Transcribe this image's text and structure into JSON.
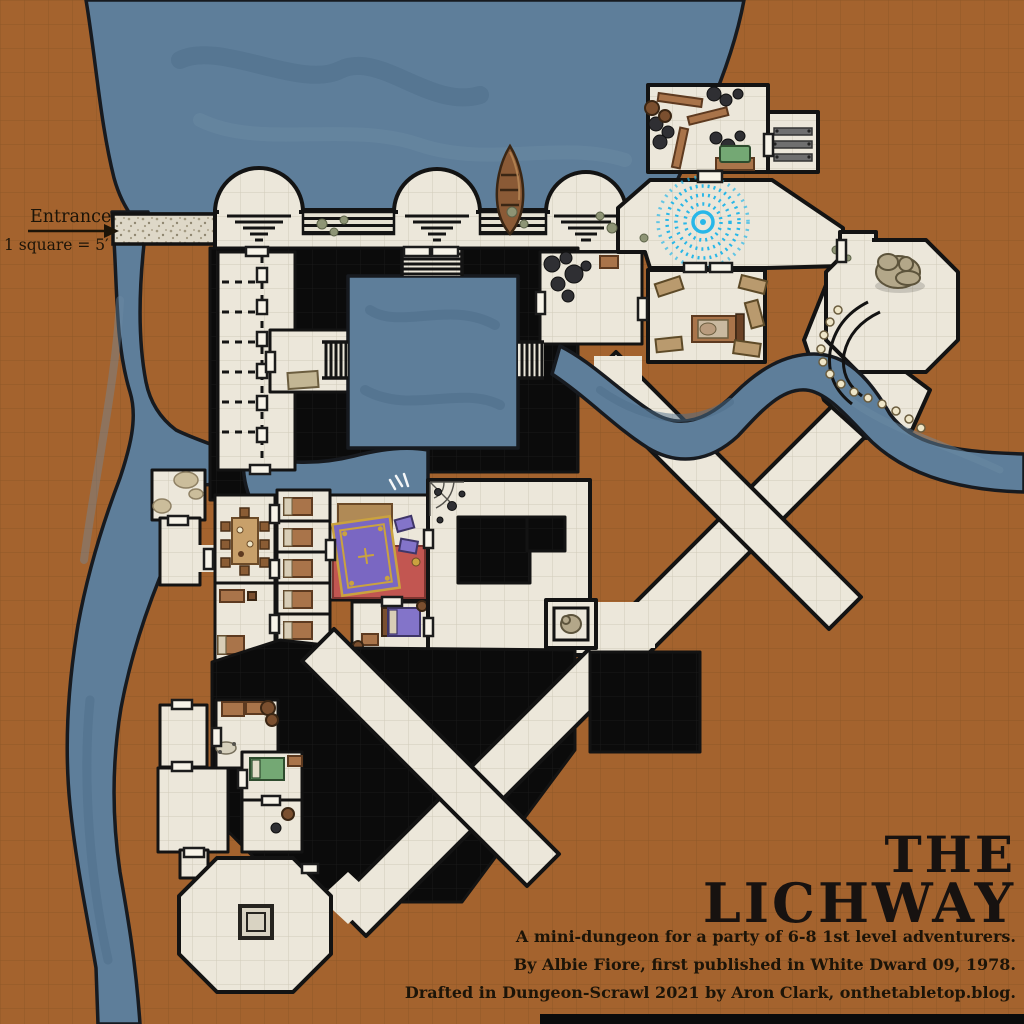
{
  "labels": {
    "entrance": "Entrance",
    "scale": "1 square = 5′"
  },
  "title": {
    "line1": "THE",
    "line2": "LICHWAY"
  },
  "credits": {
    "line1": "A mini-dungeon for a party of 6-8 1st level adventurers.",
    "line2": "By Albie Fiore, first published in White Dward 09, 1978.",
    "line3": "Drafted in Dungeon-Scrawl 2021 by Aron Clark, onthetabletop.blog."
  },
  "colors": {
    "rock": "#a4632e",
    "rockLine": "#7e4e22",
    "water": "#5e7e9a",
    "floor": "#ece7da",
    "floorLine": "#c6bfab",
    "wall": "#131313",
    "voidBlack": "#0b0b0b",
    "spiral": "#28b7e8",
    "carpetRed": "#c25651",
    "rugPurple": "#7a67c2",
    "rugGold": "#caa23f",
    "bedPurple": "#8374c9",
    "chestGreen": "#74a874",
    "wood": "#a9744a",
    "woodDark": "#7a4f2f",
    "stone": "#b3a789",
    "pearl": "#efe6c8",
    "gravel": "#ded8c8"
  }
}
